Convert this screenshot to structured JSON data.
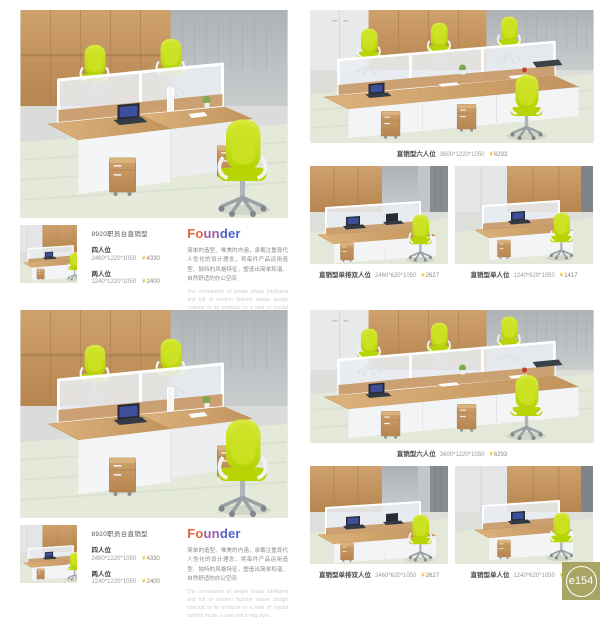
{
  "product": {
    "title": "8920职员台直销型",
    "items": [
      {
        "label": "四人位",
        "dims": "2460*1220*1050",
        "currency": "¥",
        "price": "4330"
      },
      {
        "label": "两人位",
        "dims": "1240*1220*1050",
        "currency": "¥",
        "price": "2400"
      }
    ]
  },
  "founder": {
    "part1": "Fo",
    "part2": "un",
    "part3": "der",
    "zh": "简单的造型、唯美的内涵，承载注重现代人性化的设计理念，将每件产品运用造型、独特的风格特征，塑造出简单和谐、自然舒适的办公空间",
    "en": "The connotation of simple shape intelligent and full of modern fashion nature design concept to its products to a kind of crystal tasteful mode, a seat and a ring style."
  },
  "captions": {
    "six": {
      "name": "直销型六人位",
      "dims": "3600*1220*1050",
      "currency": "¥",
      "price": "6293"
    },
    "double": {
      "name": "直销型单排双人位",
      "dims": "2460*620*1050",
      "currency": "¥",
      "price": "2627"
    },
    "single": {
      "name": "直销型单人位",
      "dims": "1240*620*1050",
      "currency": "¥",
      "price": "1417"
    }
  },
  "badge": {
    "label": "e154"
  },
  "colors": {
    "chair_green": "#c6df0f",
    "wood": "#c9996a",
    "badge_bg": "#a8a464",
    "price_yellow": "#e5b70a"
  }
}
